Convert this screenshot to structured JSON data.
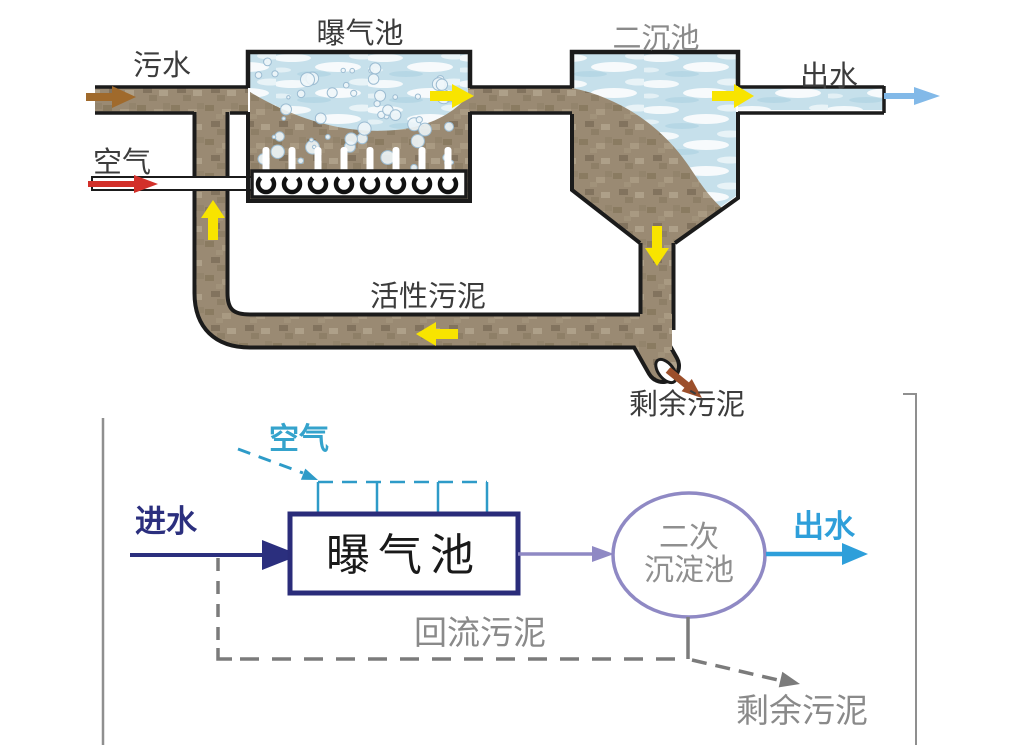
{
  "top_diagram": {
    "labels": {
      "aeration_tank": "曝气池",
      "secondary_clarifier": "二沉池",
      "influent": "污水",
      "effluent": "出水",
      "air": "空气",
      "activated_sludge": "活性污泥",
      "excess_sludge": "剩余污泥"
    },
    "colors": {
      "sludge": "#9a8a73",
      "water": "#c6e0eb",
      "flow_arrow_yellow": "#f8e400",
      "air_arrow_red": "#d2302a",
      "influent_arrow_brown": "#a06a2c",
      "effluent_arrow_blue": "#82b9e8",
      "excess_sludge_arrow_brown": "#9c4f2b"
    }
  },
  "bottom_diagram": {
    "labels": {
      "air": "空气",
      "influent": "进水",
      "aeration_tank": "曝气池",
      "clarifier_line1": "二次",
      "clarifier_line2": "沉淀池",
      "effluent": "出水",
      "return_sludge": "回流污泥",
      "excess_sludge": "剩余污泥"
    },
    "colors": {
      "air_cyan": "#35a3cc",
      "influent_navy": "#2b2f7e",
      "tank_border_navy": "#2a2c7a",
      "clarifier_purple": "#8f89c4",
      "effluent_blue": "#2e9fda",
      "sludge_gray": "#7b7b7b"
    }
  }
}
